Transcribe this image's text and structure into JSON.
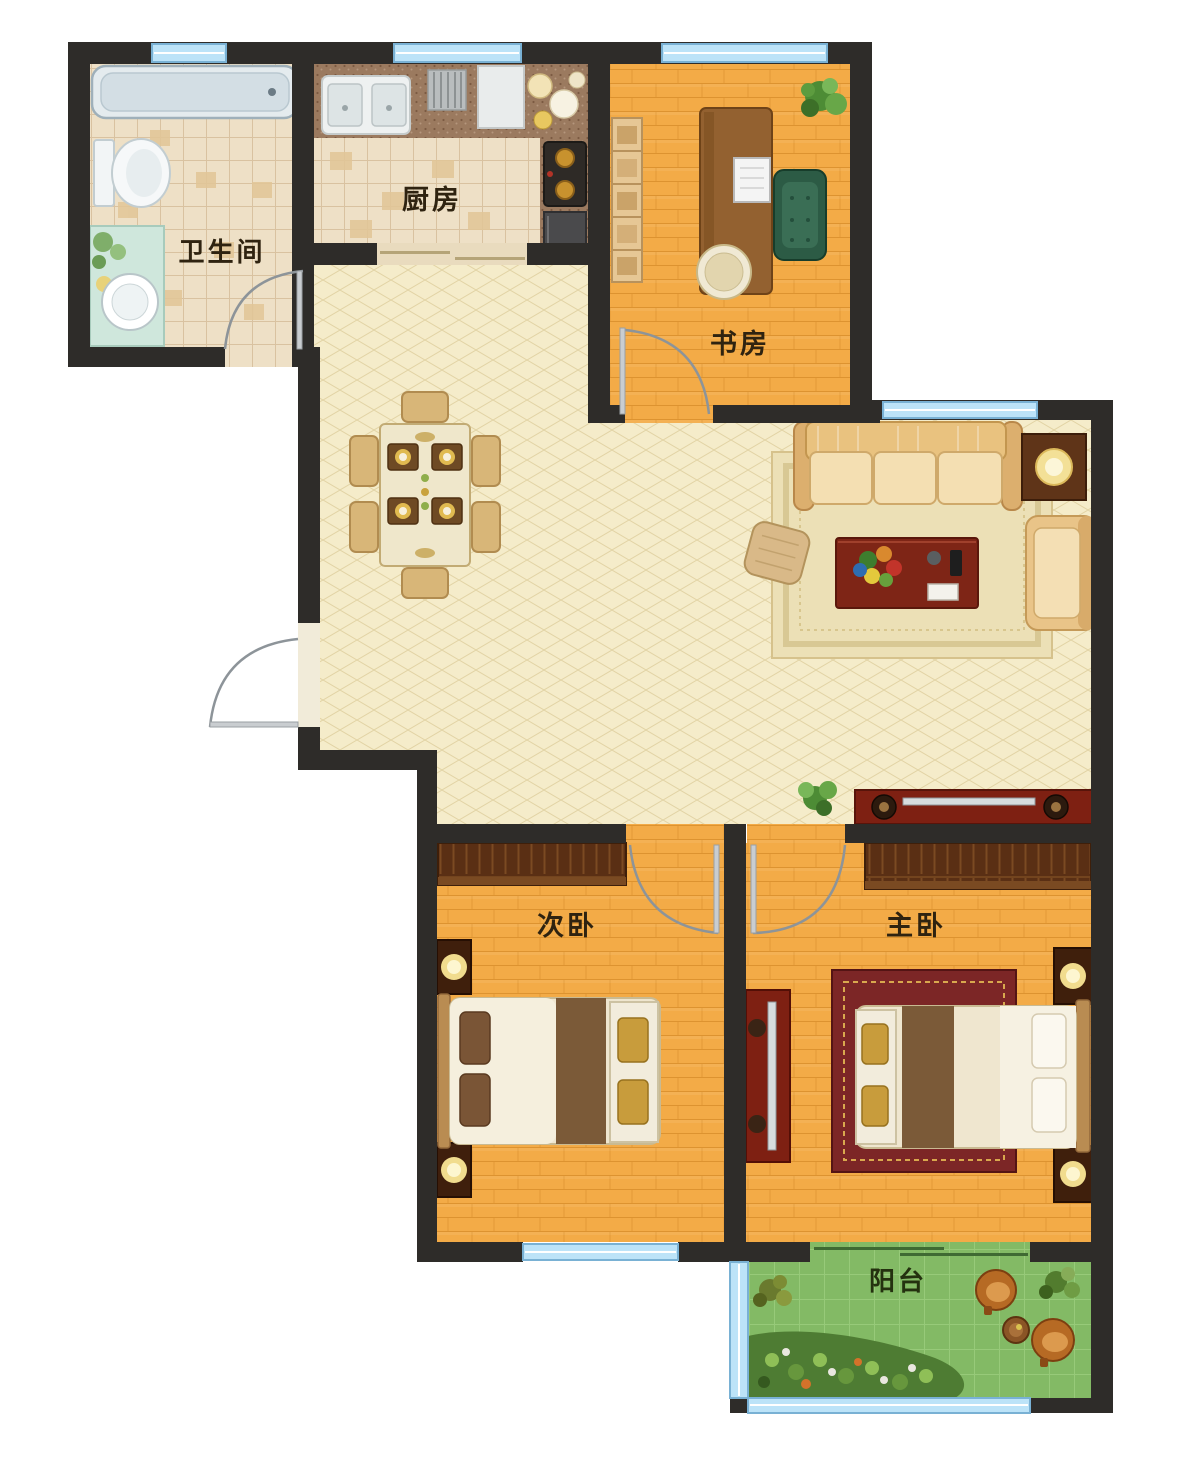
{
  "plan": {
    "type": "apartment-floor-plan",
    "rooms": {
      "bathroom": {
        "label": "卫生间",
        "furniture": [
          "bathtub",
          "toilet",
          "vanity-sink"
        ]
      },
      "kitchen": {
        "label": "厨房",
        "furniture": [
          "double-sink",
          "counter",
          "stove",
          "refrigerator"
        ]
      },
      "study": {
        "label": "书房",
        "furniture": [
          "bookshelf",
          "desk",
          "monitor",
          "office-chair",
          "round-stool",
          "plant"
        ]
      },
      "dining_hall": {
        "label": "",
        "furniture": [
          "dining-table",
          "six-chairs"
        ]
      },
      "living_room": {
        "label": "",
        "furniture": [
          "sofa",
          "armchair",
          "pouf",
          "coffee-table",
          "lamp-table",
          "rug",
          "tv-stand",
          "plant"
        ]
      },
      "secondary_bedroom": {
        "label": "次卧",
        "furniture": [
          "wardrobe",
          "double-bed",
          "bench",
          "nightstand-lamps"
        ]
      },
      "master_bedroom": {
        "label": "主卧",
        "furniture": [
          "wardrobe",
          "double-bed",
          "bench",
          "nightstand-lamps",
          "tv-cabinet",
          "rug"
        ]
      },
      "balcony": {
        "label": "阳台",
        "furniture": [
          "rattan-chairs",
          "small-table",
          "plants",
          "flower-bed"
        ]
      }
    },
    "colors": {
      "wall": "#2e2c29",
      "window_glass": "#bce3f8",
      "window_frame": "#79b1d4",
      "wood_floor": "#f3ab47",
      "tile_floor": "#eee0c6",
      "hall_floor": "#f5ecca",
      "balcony_floor": "#83ba65",
      "wardrobe_wood": "#5a2f14",
      "tv_cabinet_red": "#7e2012",
      "exterior": "#ffffff"
    }
  }
}
